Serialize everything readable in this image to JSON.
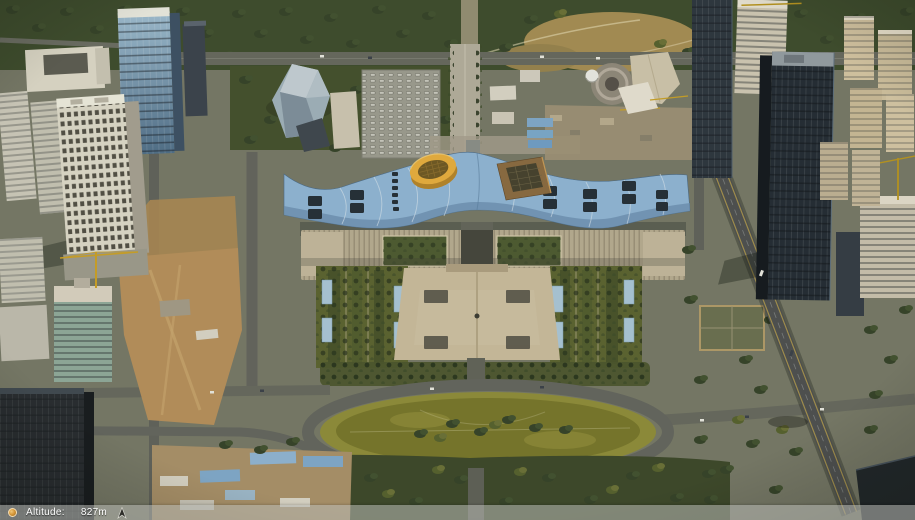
{
  "app": {
    "type": "3d-earth-viewer"
  },
  "status_bar": {
    "altitude_label": "Altitude:",
    "altitude_value": "827m",
    "left_icon": "streaming-status-icon",
    "right_icon": "compass-north-icon"
  },
  "colors": {
    "urban_base": "#757868",
    "park_green": "#3d4b2e",
    "hill_tan": "#a58d55",
    "roof_blue": "#8fb5d6",
    "roof_shadow": "#688cb0",
    "cylinder_yellow": "#e6ad3f",
    "pyramid_brown": "#8a6a42",
    "plaza_tan": "#c9bb9e",
    "grass_olive": "#76752c",
    "dirt_orange": "#b68f5c",
    "road_gray": "#66685f",
    "road_dark": "#4c4f51",
    "construction_blue": "#7fa8cc",
    "statusbar_bg": "rgba(186,188,182,0.55)"
  }
}
